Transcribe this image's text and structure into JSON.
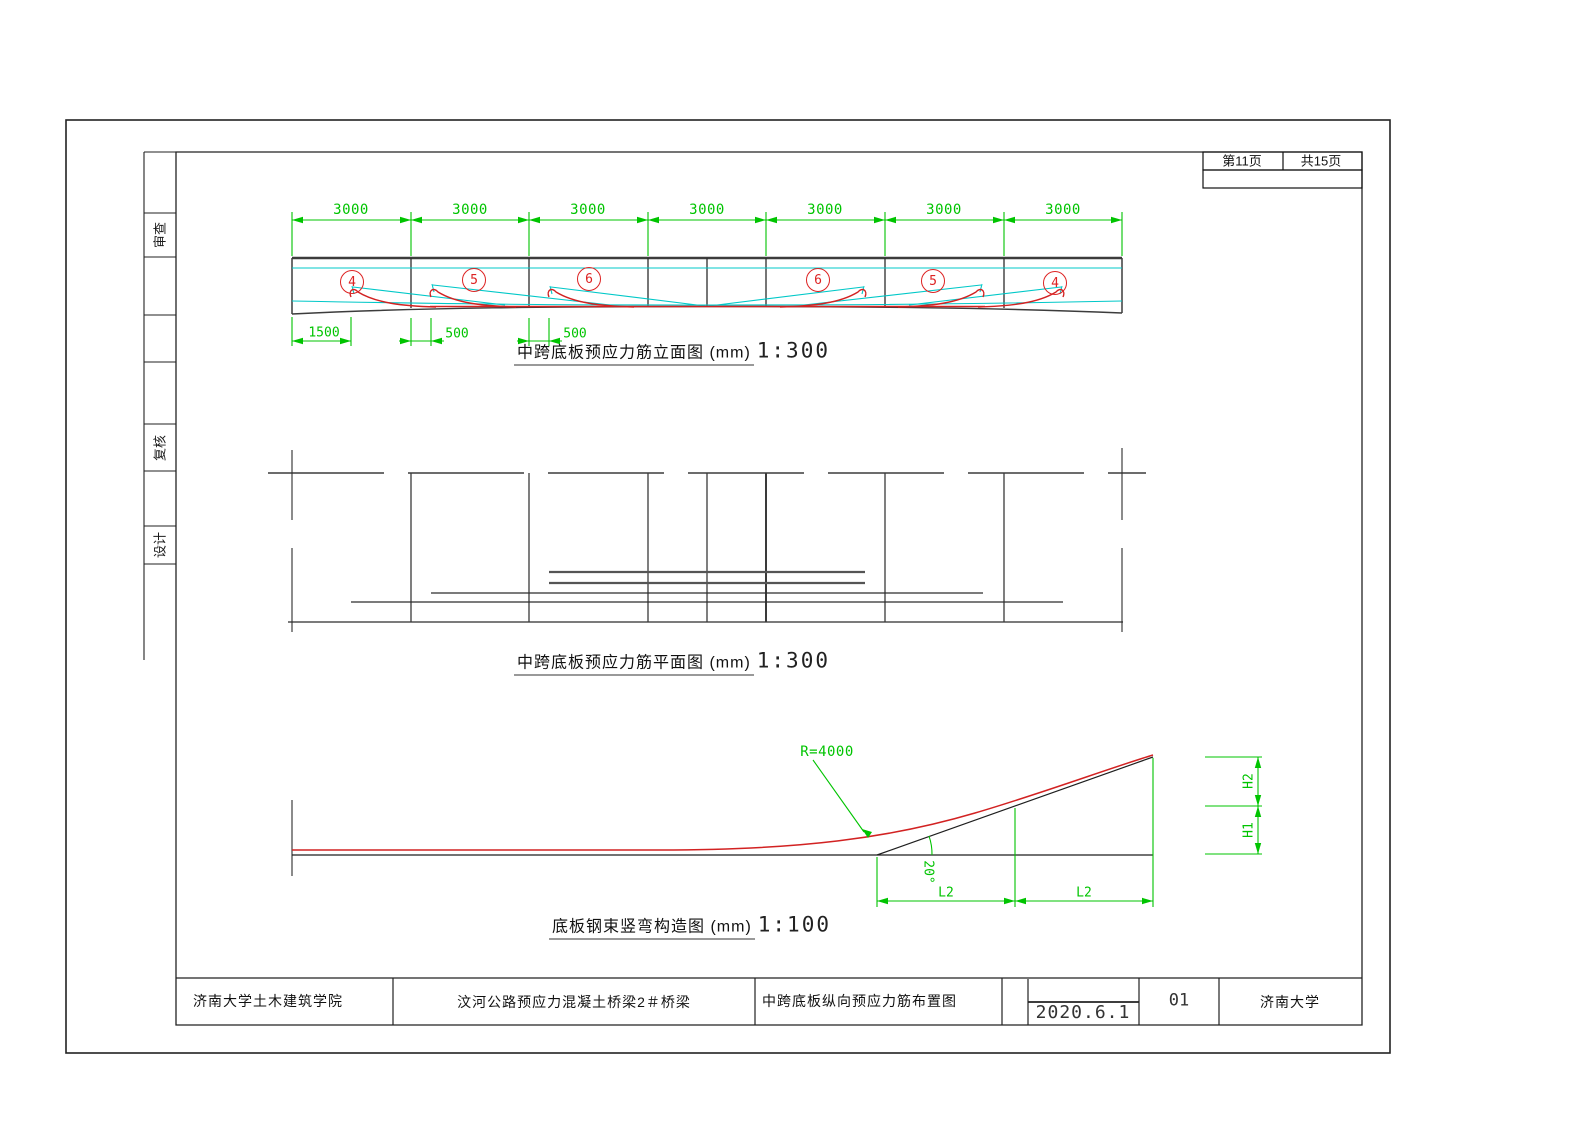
{
  "page_info": {
    "page": "第11页",
    "total": "共15页"
  },
  "sidebar": {
    "items": [
      {
        "label": "审查"
      },
      {
        "label": "复核"
      },
      {
        "label": "设计"
      }
    ]
  },
  "elevation": {
    "title": {
      "label": "中跨底板预应力筋立面图 (mm)",
      "scale": "1:300"
    },
    "top_dims": [
      "3000",
      "3000",
      "3000",
      "3000",
      "3000",
      "3000",
      "3000"
    ],
    "bottom_dims": [
      "1500",
      "500",
      "500"
    ],
    "tendon_labels": [
      "4",
      "5",
      "6",
      "6",
      "5",
      "4"
    ]
  },
  "plan": {
    "title": {
      "label": "中跨底板预应力筋平面图 (mm)",
      "scale": "1:300"
    }
  },
  "detail": {
    "title": {
      "label": "底板钢束竖弯构造图 (mm)",
      "scale": "1:100"
    },
    "radius_label": "R=4000",
    "angle_label": "20°",
    "dim_labels": [
      "L2",
      "L2"
    ],
    "height_labels": [
      "H2",
      "H1"
    ]
  },
  "title_block": {
    "org": "济南大学土木建筑学院",
    "project": "汶河公路预应力混凝土桥梁2＃桥梁",
    "drawing_title": "中跨底板纵向预应力筋布置图",
    "date": "2020.6.1",
    "sheet_no": "01",
    "university": "济南大学"
  },
  "colors": {
    "dim_green": "#00c400",
    "tendon_red": "#d22222",
    "tendon_cyan": "#00c8c8",
    "outline_dark": "#3c3c3c"
  }
}
